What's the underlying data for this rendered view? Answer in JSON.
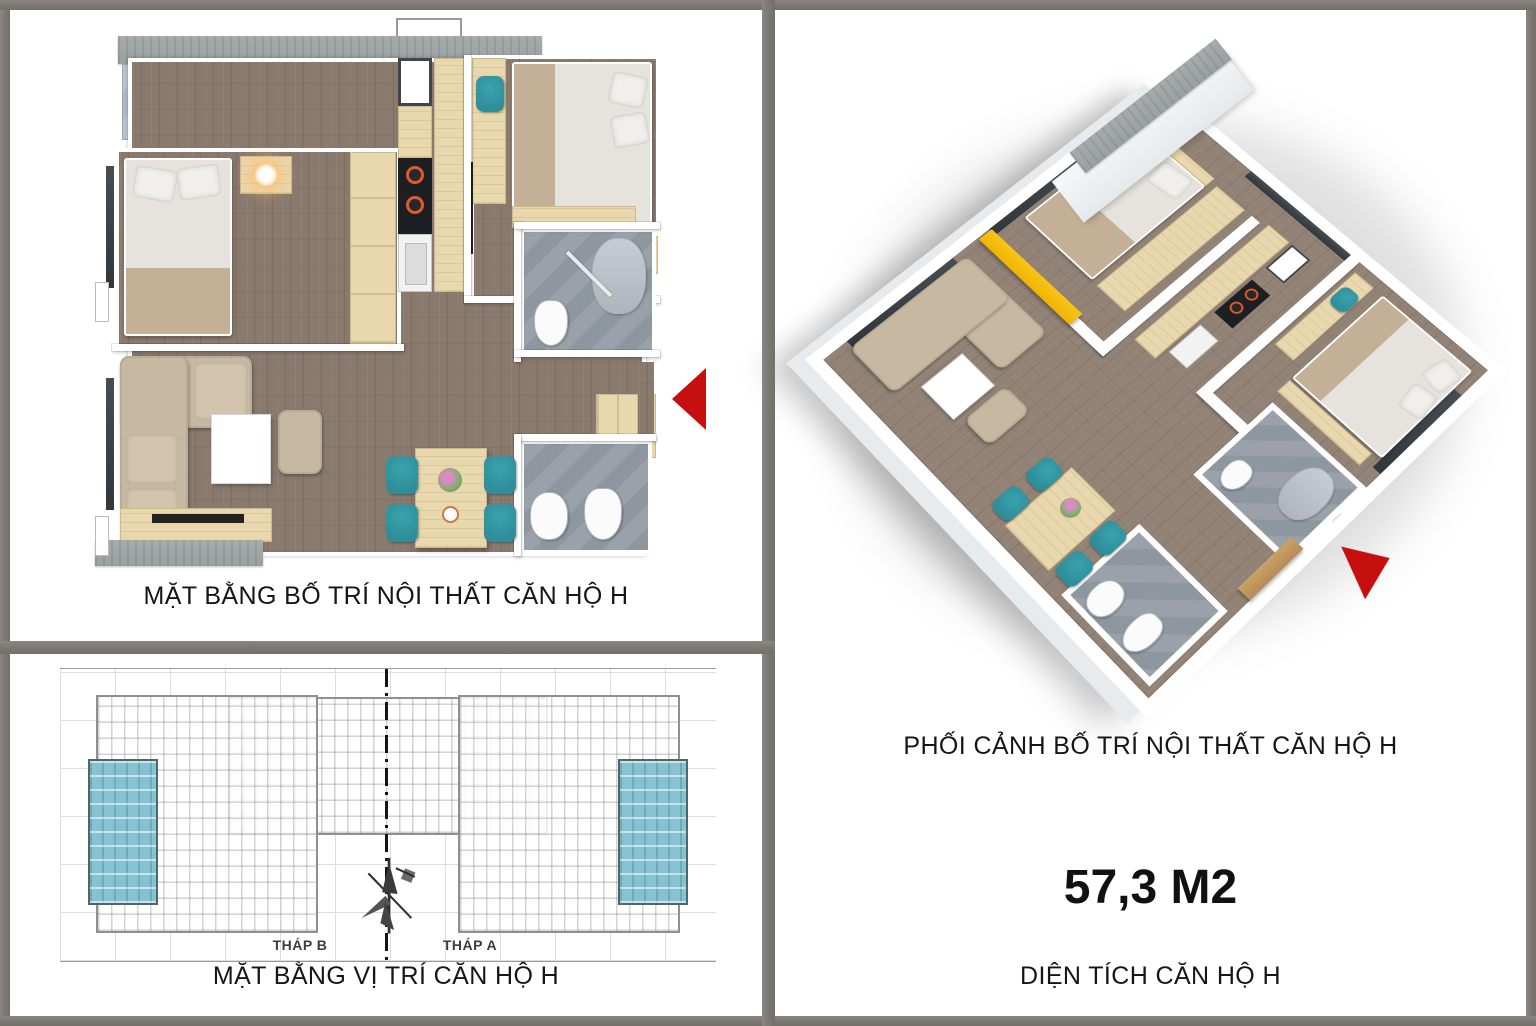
{
  "document": {
    "floor_plan": {
      "caption": "MẶT BẰNG BỐ TRÍ NỘI THẤT CĂN HỘ H"
    },
    "site_plan": {
      "caption": "MẶT BẰNG VỊ TRÍ CĂN HỘ H",
      "tower_b": "THÁP B",
      "tower_a": "THÁP A"
    },
    "perspective": {
      "caption": "PHỐI CẢNH BỐ TRÍ NỘI THẤT CĂN HỘ H",
      "area_value": "57,3 M2",
      "area_label": "DIỆN TÍCH CĂN HỘ H"
    }
  },
  "icons": {
    "entry_arrow": "red triangle pointing left at apartment entrance",
    "view_arrow": "red triangle pointing down-left at 3D entrance",
    "north_compass": "windmill style north symbol"
  },
  "colors": {
    "frame": "#7e7b77",
    "text": "#1c1c1c",
    "wood": "#8a7a6e",
    "light_wood": "#e9d7ad",
    "concrete": "#9aa0a1",
    "tile": "#b2bcc8",
    "bath": "#8e96a0",
    "sofa": "#c7b8a1",
    "teal": "#2e8f9b",
    "yellow": "#f0b400",
    "red": "#c60f0f",
    "unit_teal": "#85c3d2"
  }
}
